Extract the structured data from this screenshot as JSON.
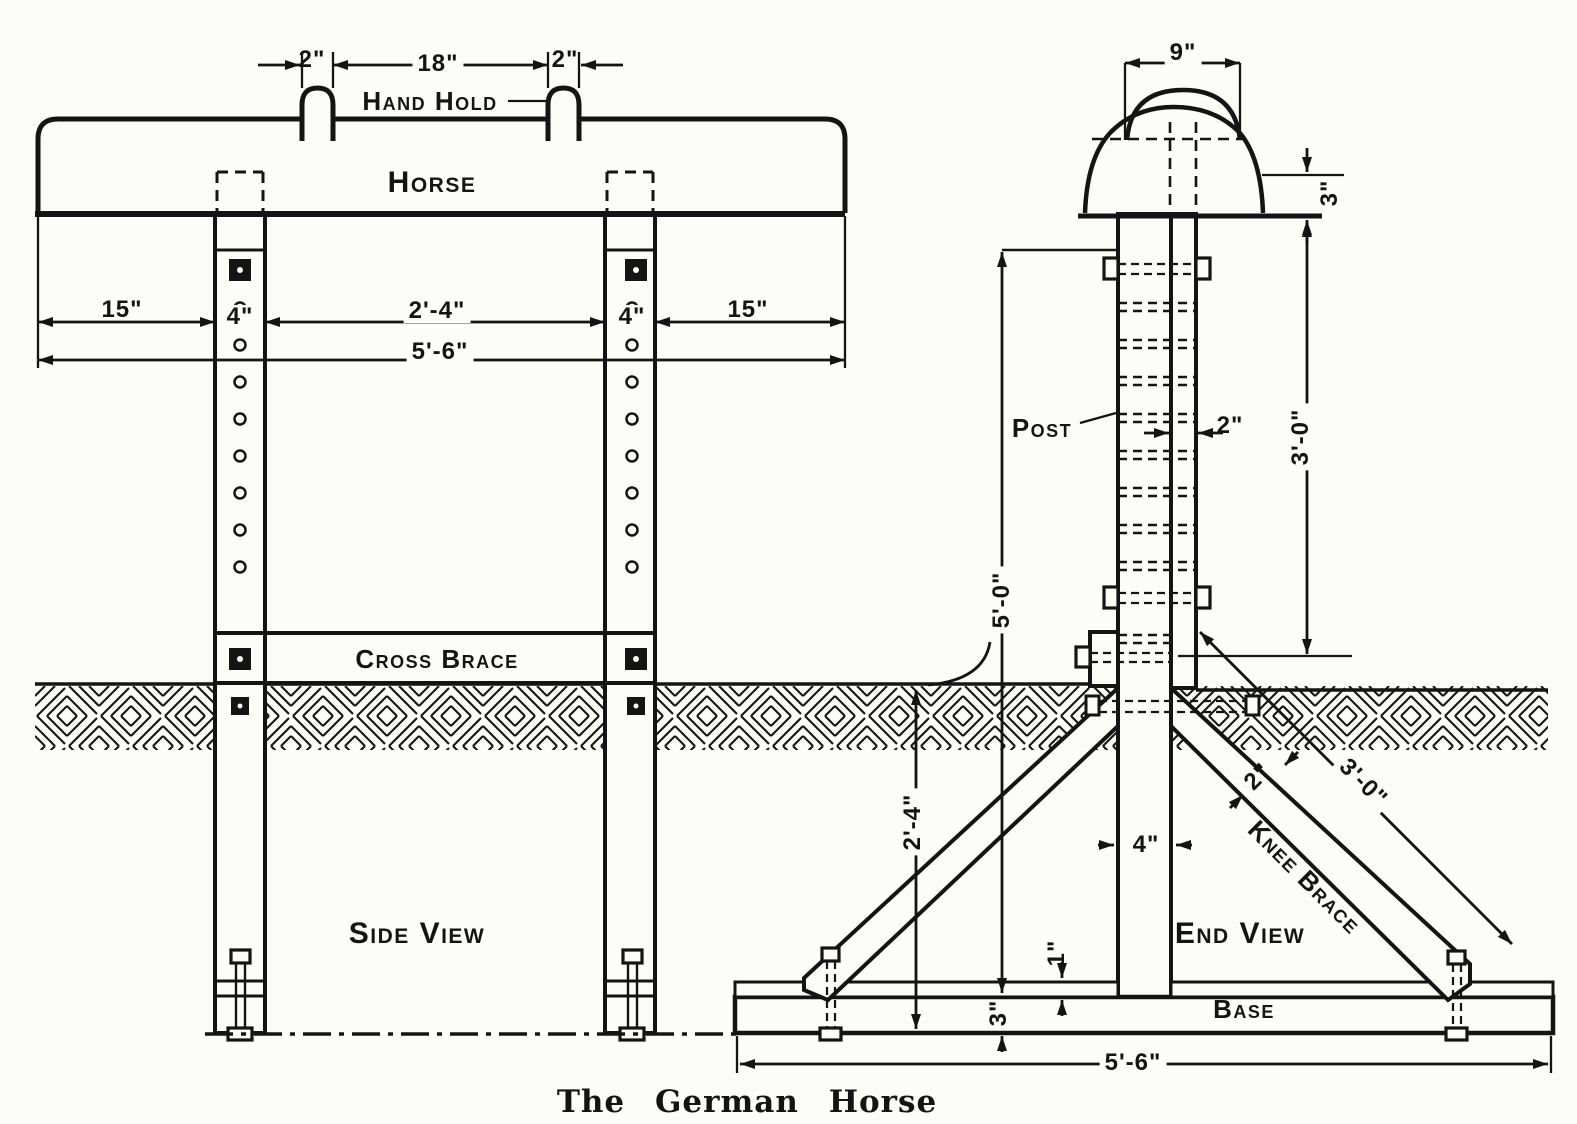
{
  "caption": "The German Horse",
  "labels": {
    "horse": "Horse",
    "hand_hold": "Hand Hold",
    "cross_brace": "Cross Brace",
    "side_view": "Side View",
    "end_view": "End View",
    "post": "Post",
    "knee_brace": "Knee Brace",
    "base": "Base"
  },
  "dims": {
    "hand_hold_width_left": "2\"",
    "hand_hold_gap": "18\"",
    "hand_hold_width_right": "2\"",
    "overhang_left": "15\"",
    "post_width_left": "4\"",
    "post_gap": "2'-4\"",
    "post_width_right": "4\"",
    "overhang_right": "15\"",
    "horse_length": "5'-6\"",
    "top_width": "9\"",
    "body_depth": "3\"",
    "rail_width": "2\"",
    "height_above_ground": "3'-0\"",
    "post_length": "5'-0\"",
    "buried_depth": "2'-4\"",
    "knee_brace_width": "2\"",
    "knee_brace_length": "3'-0\"",
    "post_width_end": "4\"",
    "cleat_thickness": "1\"",
    "base_thickness": "3\"",
    "base_length": "5'-6\""
  },
  "ink_color": "#141414",
  "paper_color": "#fcfcf9"
}
